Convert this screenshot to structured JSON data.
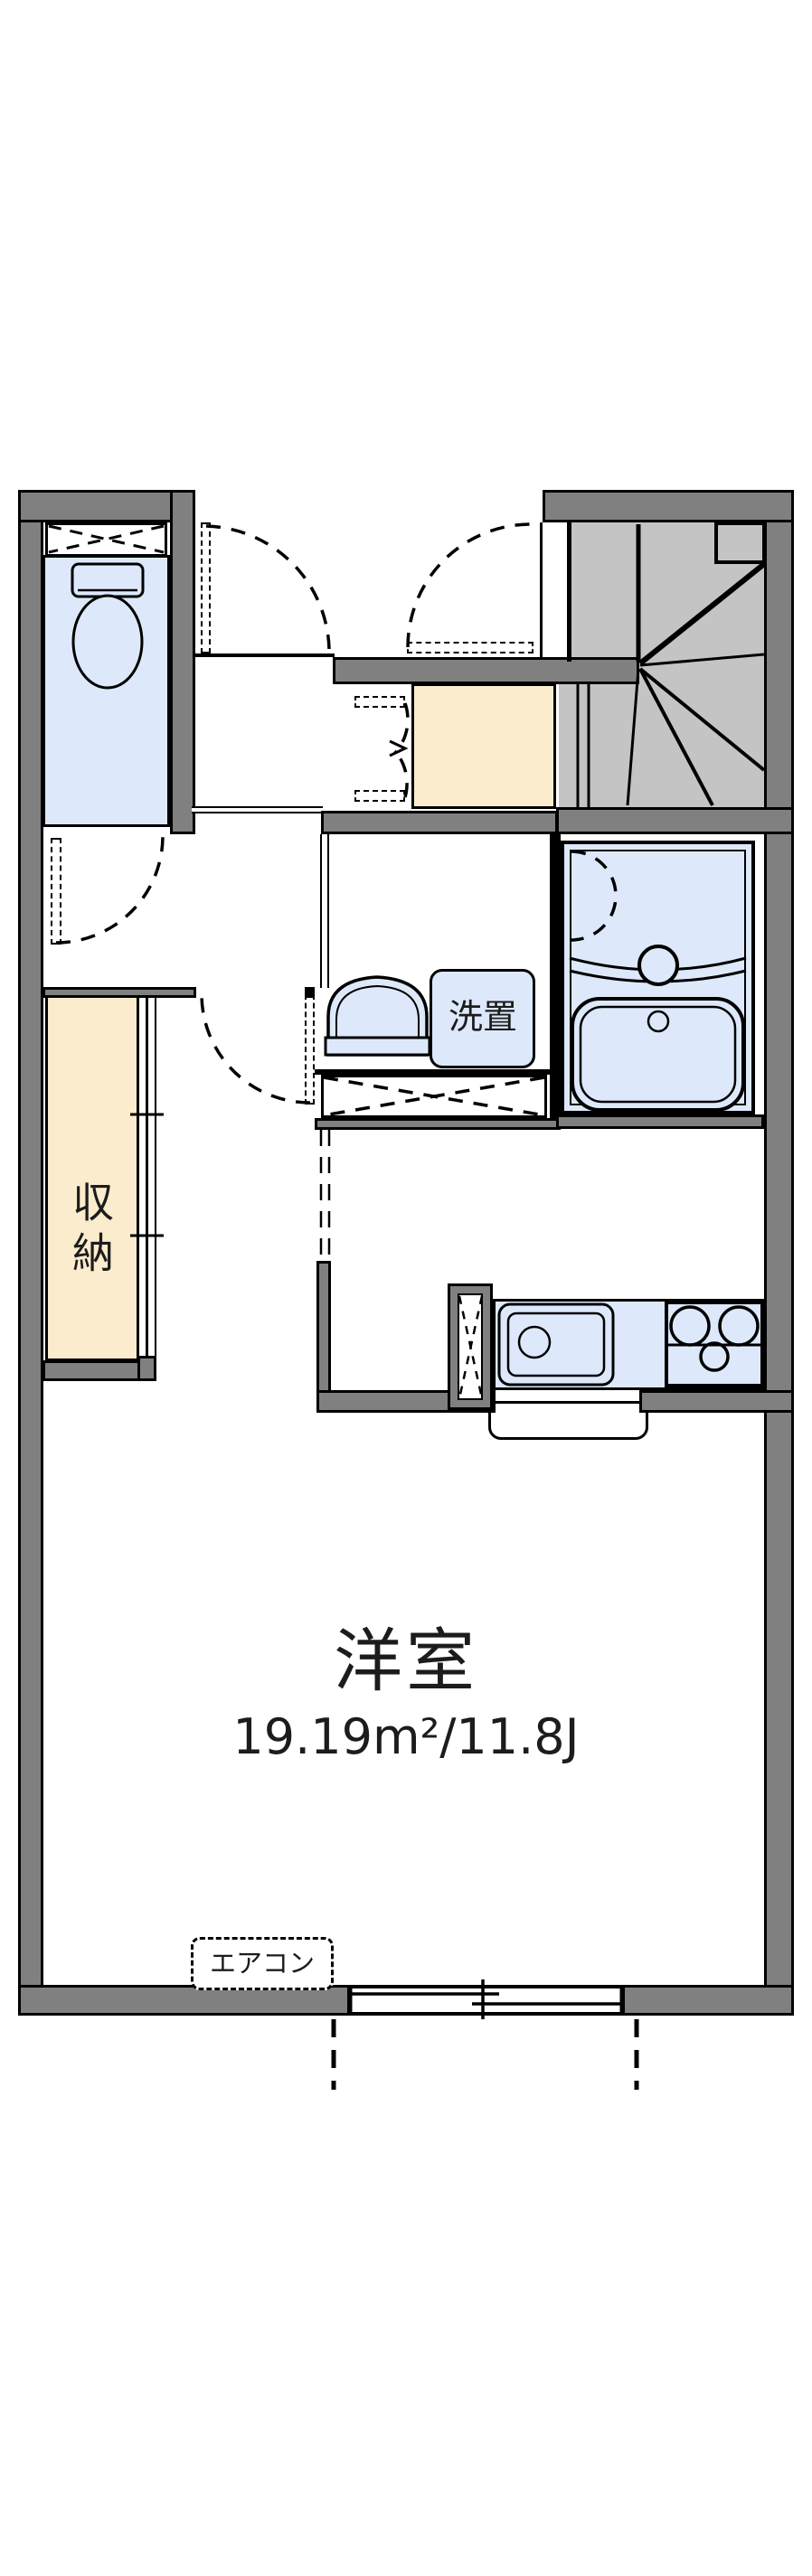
{
  "floorplan": {
    "type": "apartment-floor-plan",
    "rooms": {
      "western_room": {
        "label": "洋室",
        "area": "19.19m²/11.8J"
      },
      "storage": {
        "label": "収納"
      },
      "washer_place": {
        "label": "洗置"
      },
      "aircon": {
        "label": "エアコン"
      }
    },
    "colors": {
      "wall": "#808080",
      "stair": "#c4c4c4",
      "blue": "#dde9fa",
      "cream": "#faeccd",
      "line": "#000000",
      "text": "#1c1c1c"
    }
  }
}
